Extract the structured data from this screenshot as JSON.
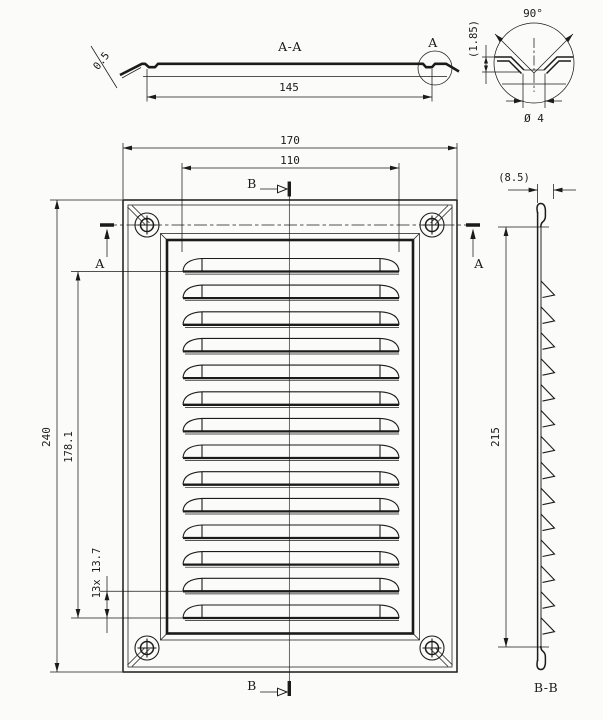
{
  "meta": {
    "type": "technical-drawing",
    "subject": "louvered ventilation grille, three views with section details"
  },
  "colors": {
    "line": "#1b1b1b",
    "background": "#fbfbfa"
  },
  "section_aa": {
    "title": "A-A",
    "detail_marker": "A",
    "sheet_thickness": "0.5",
    "hole_spacing": "145"
  },
  "detail_a": {
    "countersink_angle": "90°",
    "countersink_depth": "(1.85)",
    "hole_diameter": "Ø 4"
  },
  "front_view": {
    "overall_width": "170",
    "louver_width": "110",
    "overall_height": "240",
    "louver_span": "178.1",
    "louver_pitch": "13x 13.7",
    "section_a_label": "A",
    "section_a_label_right": "A",
    "section_b_label_top": "B",
    "section_b_label_bottom": "B",
    "louver_count": 14
  },
  "section_bb": {
    "title": "B-B",
    "depth": "(8.5)",
    "inner_height": "215",
    "teeth_count": 14
  }
}
